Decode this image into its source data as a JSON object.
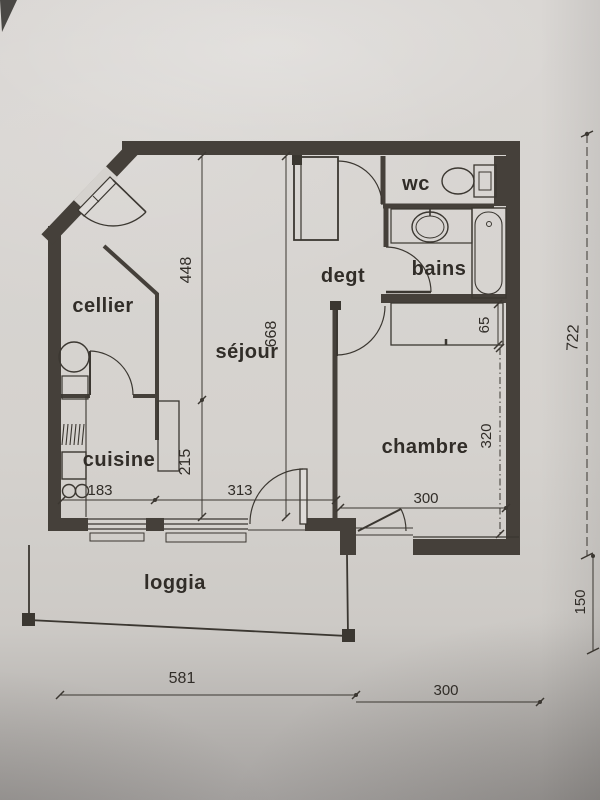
{
  "rooms": {
    "cellier": "cellier",
    "cuisine": "cuisine",
    "sejour": "séjour",
    "degt": "degt",
    "wc": "wc",
    "bains": "bains",
    "chambre": "chambre",
    "loggia": "loggia"
  },
  "dimensions": {
    "d448": "448",
    "d668": "668",
    "d215": "215",
    "d183": "183",
    "d313": "313",
    "d300_chambre": "300",
    "d65": "65",
    "d320": "320",
    "d722": "722",
    "d150": "150",
    "d581": "581",
    "d300_bottom": "300"
  },
  "colors": {
    "paper": "#d5d2ce",
    "ink": "#3b3731",
    "wall": "#45403a"
  }
}
